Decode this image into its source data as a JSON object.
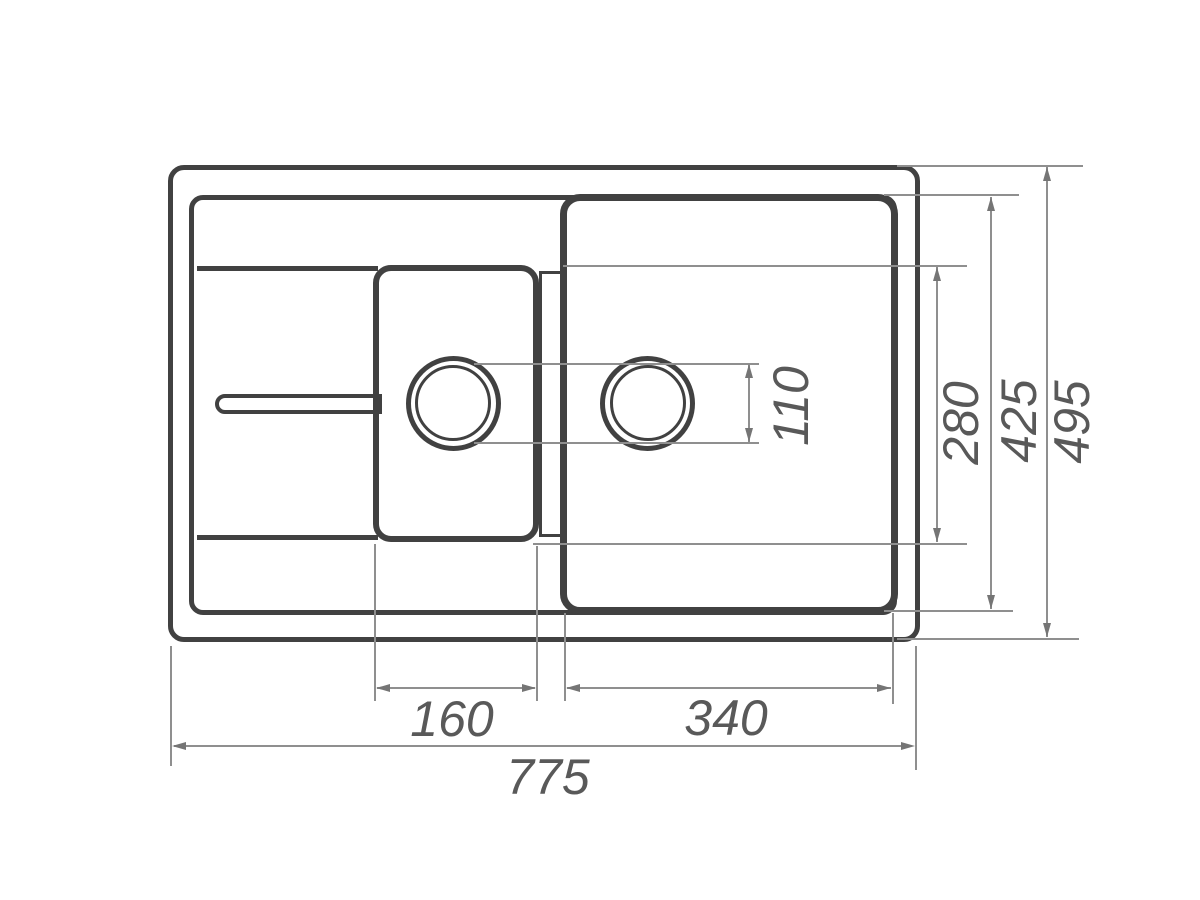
{
  "drawing": {
    "type": "technical-dimension-drawing",
    "subject": "kitchen sink with one and a half bowls and drainboard, top view",
    "colors": {
      "outline": "#414141",
      "dimension_line": "#8f8f8f",
      "arrow": "#757575",
      "label_text": "#595959",
      "background": "#ffffff"
    },
    "dimensions": {
      "overall_width": "775",
      "overall_depth": "495",
      "main_bowl_outer_depth": "425",
      "main_bowl_inner_depth": "280",
      "drain_diameter": "110",
      "half_bowl_width": "160",
      "main_bowl_width": "340"
    }
  }
}
